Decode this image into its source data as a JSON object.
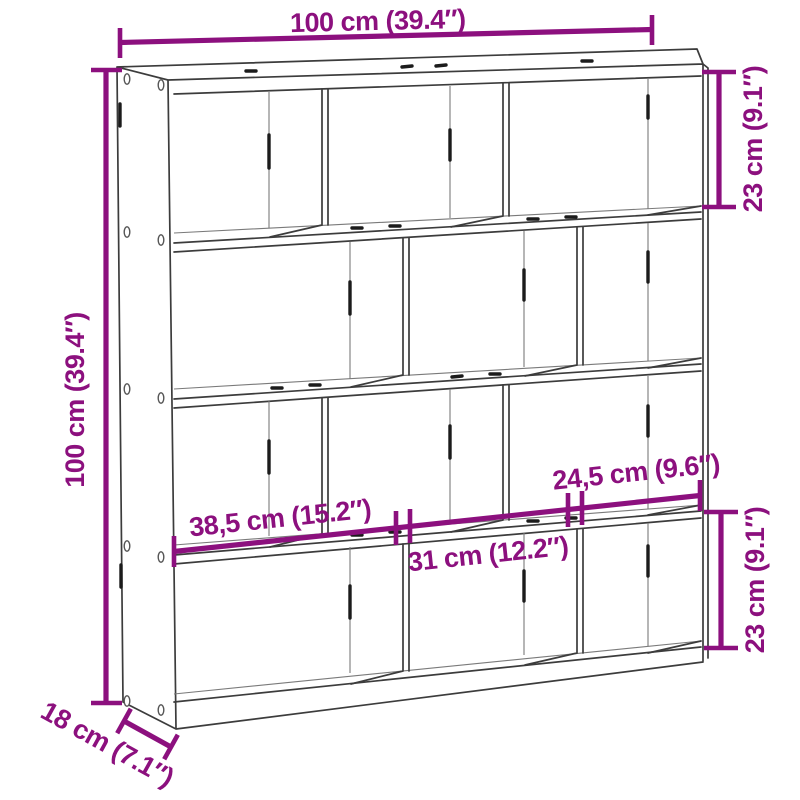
{
  "dimensions": {
    "overall_width": "100 cm (39.4″)",
    "overall_height": "100 cm (39.4″)",
    "top_cube_height": "23 cm (9.1″)",
    "bottom_cube_height": "23 cm (9.1″)",
    "compartment_width_left": "38,5 cm (15.2″)",
    "compartment_width_middle": "31 cm (12.2″)",
    "compartment_width_right": "24,5 cm (9.6″)",
    "depth": "18 cm (7.1″)"
  },
  "colors": {
    "dimension_accent": "#8C107E",
    "drawing_outline": "#3C3C3C",
    "background": "#FFFFFF"
  }
}
